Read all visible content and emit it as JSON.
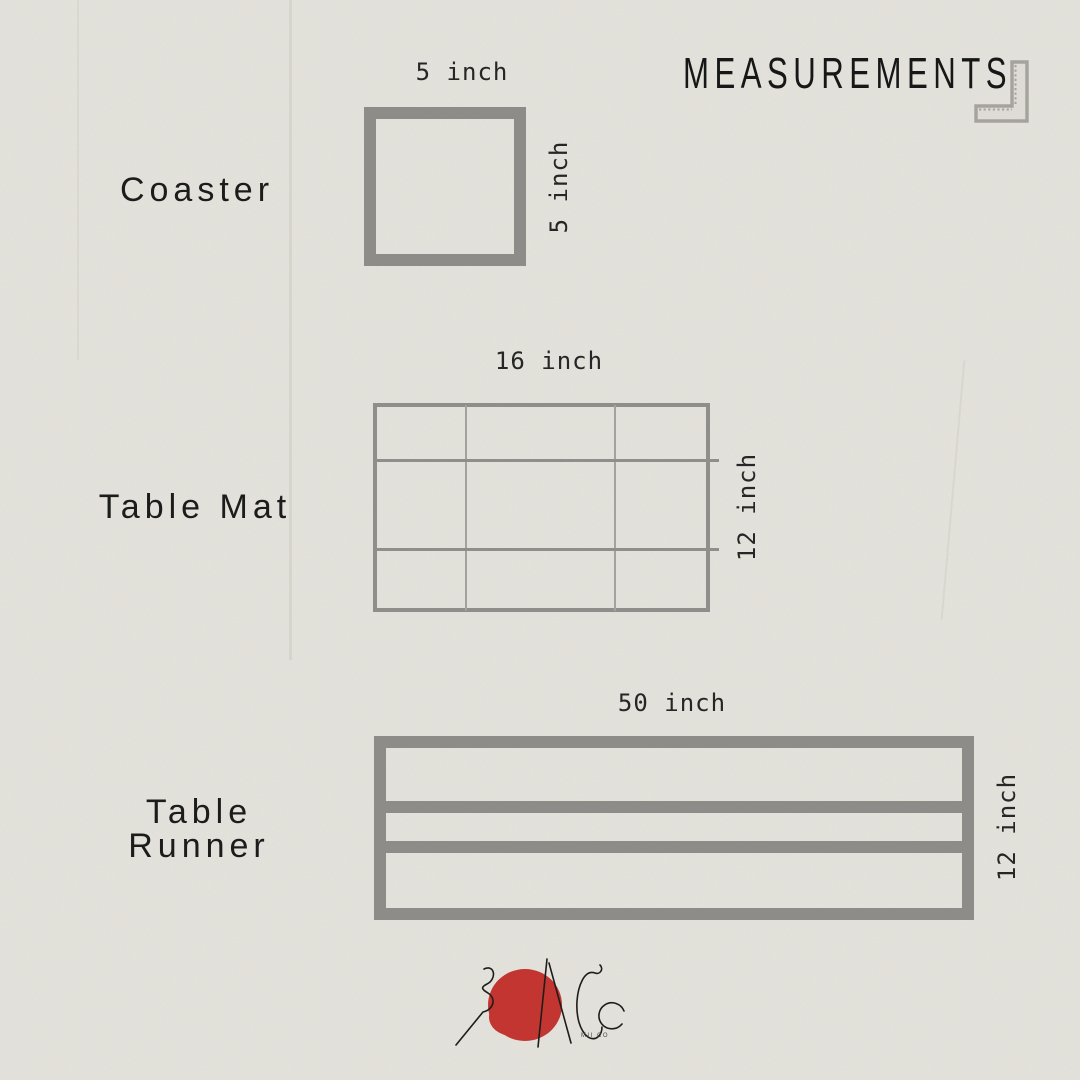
{
  "header": {
    "title": "MEASUREMENTS"
  },
  "items": [
    {
      "id": "coaster",
      "name": "Coaster",
      "name_lines": [
        "Coaster"
      ],
      "width_label": "5 inch",
      "height_label": "5 inch"
    },
    {
      "id": "table-mat",
      "name": "Table Mat",
      "name_lines": [
        "Table Mat"
      ],
      "width_label": "16 inch",
      "height_label": "12 inch"
    },
    {
      "id": "table-runner",
      "name": "Table Runner",
      "name_lines": [
        "Table",
        "Runner"
      ],
      "width_label": "50 inch",
      "height_label": "12 inch"
    }
  ],
  "logo": {
    "caption": "MII CO"
  },
  "colors": {
    "background": "#e9e7e1",
    "shape_gray": "#8d8c89",
    "grid_gray": "#a3a29e",
    "text_dark": "#1c1c1c",
    "ruler_gray": "#a6a39e",
    "logo_red": "#c23530"
  }
}
